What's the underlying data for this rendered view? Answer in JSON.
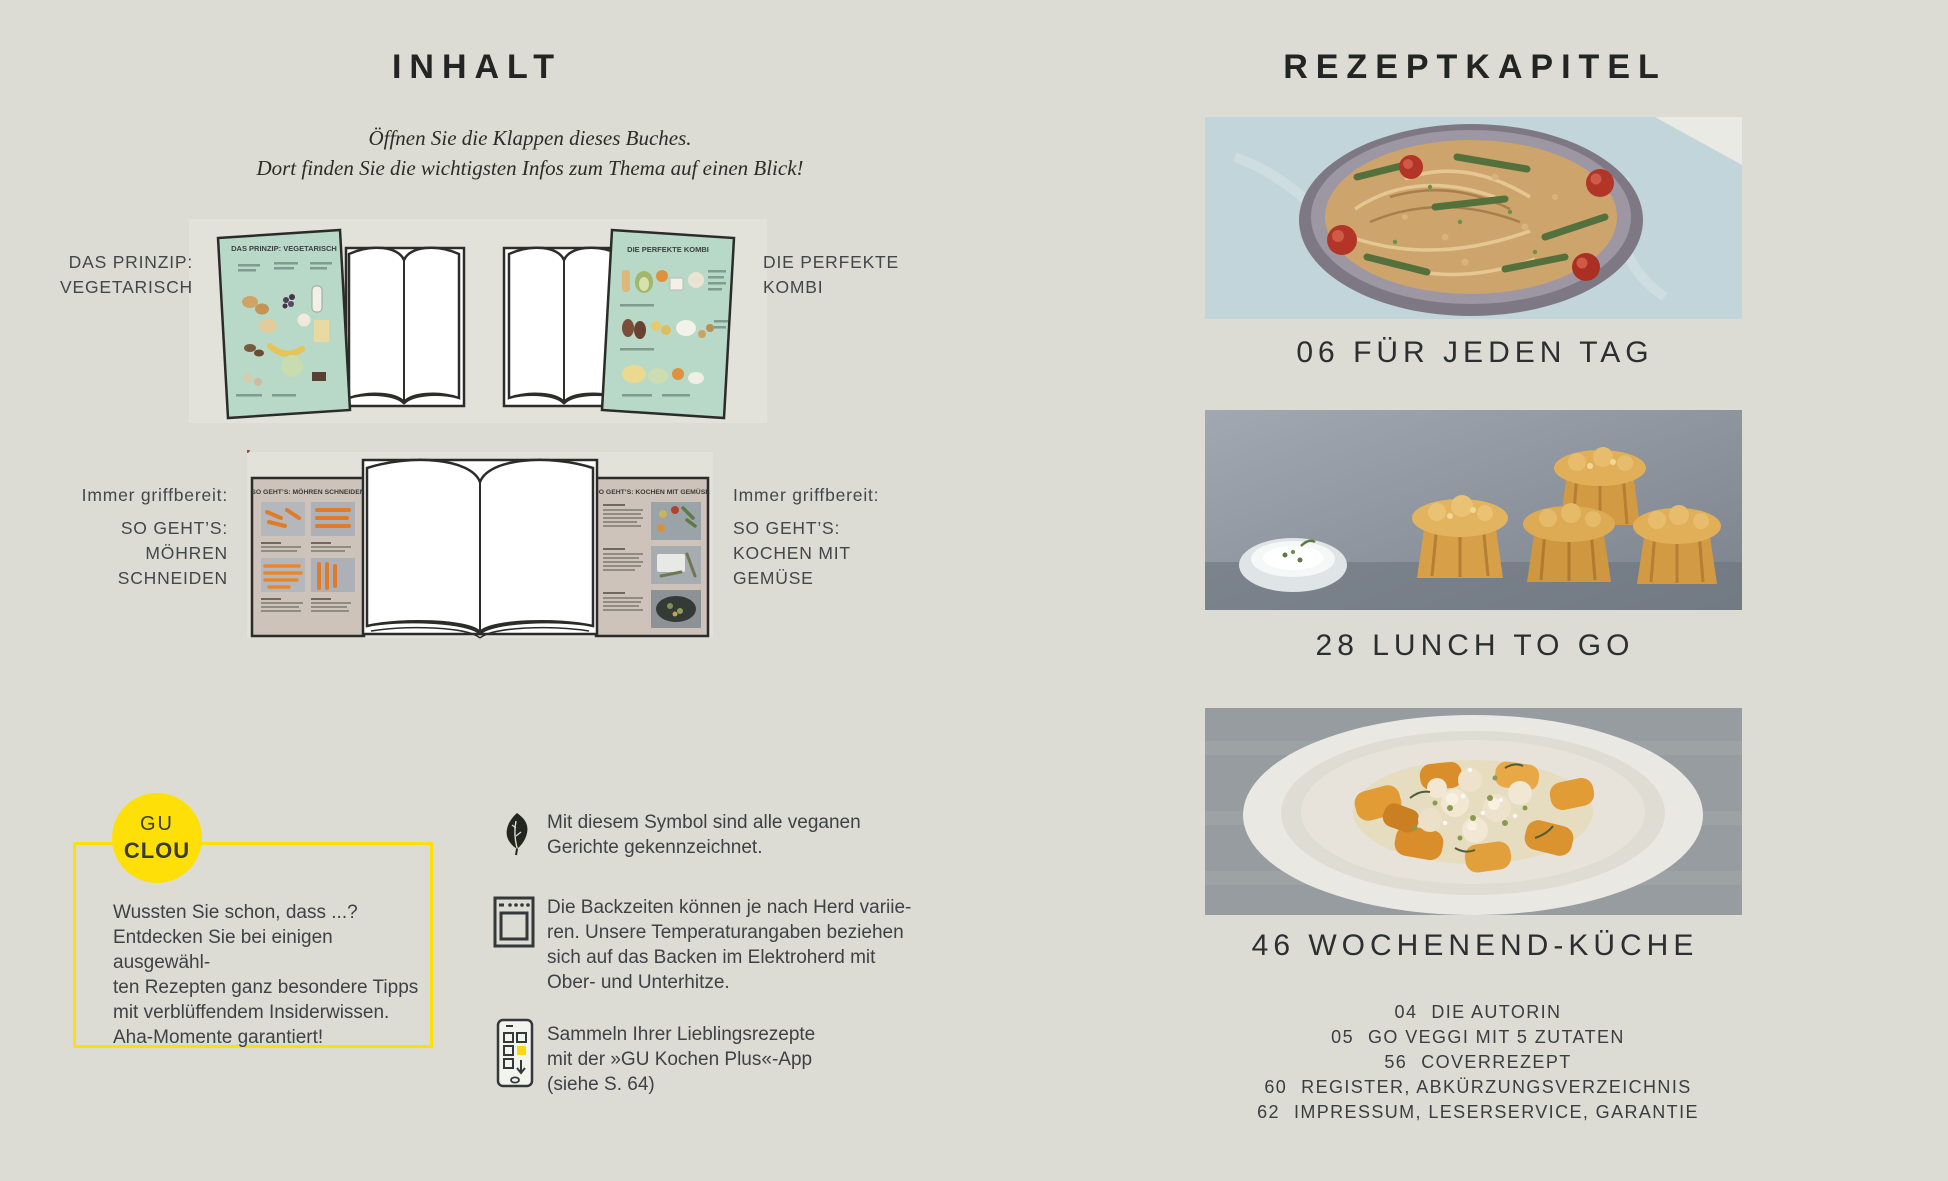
{
  "colors": {
    "page_background": "#dcdcd4",
    "accent_yellow": "#ffdf08",
    "mint_flap": "#b8d8c8",
    "beige_flap": "#cdc3bb",
    "heading_text": "#232524",
    "body_text": "#3e4246"
  },
  "left_page": {
    "title": "INHALT",
    "intro": {
      "line1": "Öffnen Sie die Klappen dieses Buches.",
      "line2": "Dort finden Sie die wichtigsten Infos zum Thema auf einen Blick!"
    },
    "book1": {
      "label_line1": "DAS PRINZIP:",
      "label_line2": "VEGETARISCH",
      "flap_title": "DAS PRINZIP: VEGETARISCH"
    },
    "book2": {
      "label_line1": "DIE PERFEKTE",
      "label_line2": "KOMBI",
      "flap_title": "DIE PERFEKTE KOMBI"
    },
    "book3": {
      "left_intro": "Immer griffbereit:",
      "left_line1": "SO GEHT’S:",
      "left_line2": "MÖHREN",
      "left_line3": "SCHNEIDEN",
      "left_flap_title": "SO GEHT’S: MÖHREN SCHNEIDEN",
      "right_intro": "Immer griffbereit:",
      "right_line1": "SO GEHT’S:",
      "right_line2": "KOCHEN MIT",
      "right_line3": "GEMÜSE",
      "right_flap_title": "SO GEHT’S: KOCHEN MIT GEMÜSE"
    },
    "clou": {
      "badge_line1": "GU",
      "badge_line2": "CLOU",
      "line1": "Wussten Sie schon, dass ...?",
      "line2": "Entdecken Sie bei einigen ausgewähl-",
      "line3": "ten Rezepten ganz besondere Tipps",
      "line4": "mit verblüffendem Insiderwissen.",
      "line5": "Aha-Momente garantiert!"
    },
    "info": {
      "vegan": {
        "line1": "Mit diesem Symbol sind alle veganen",
        "line2": "Gerichte gekennzeichnet."
      },
      "oven": {
        "line1": "Die Backzeiten können je nach Herd variie-",
        "line2": "ren. Unsere Temperaturangaben beziehen",
        "line3": "sich auf das Backen im Elektroherd mit",
        "line4": "Ober- und Unterhitze."
      },
      "app": {
        "line1": "Sammeln Ihrer Lieblingsrezepte",
        "line2": "mit der »GU Kochen Plus«-App",
        "line3": "(siehe S. 64)"
      }
    }
  },
  "right_page": {
    "title": "REZEPTKAPITEL",
    "chapters": [
      {
        "caption": "06 FÜR JEDEN TAG",
        "photo": "noodle-bowl"
      },
      {
        "caption": "28 LUNCH TO GO",
        "photo": "carrot-muffins"
      },
      {
        "caption": "46 WOCHENEND-KÜCHE",
        "photo": "pumpkin-gnocchi"
      }
    ],
    "toc": [
      {
        "page": "04",
        "label": "DIE AUTORIN"
      },
      {
        "page": "05",
        "label": "GO VEGGI MIT 5 ZUTATEN"
      },
      {
        "page": "56",
        "label": "COVERREZEPT"
      },
      {
        "page": "60",
        "label": "REGISTER, ABKÜRZUNGSVERZEICHNIS"
      },
      {
        "page": "62",
        "label": "IMPRESSUM, LESERSERVICE, GARANTIE"
      }
    ]
  }
}
